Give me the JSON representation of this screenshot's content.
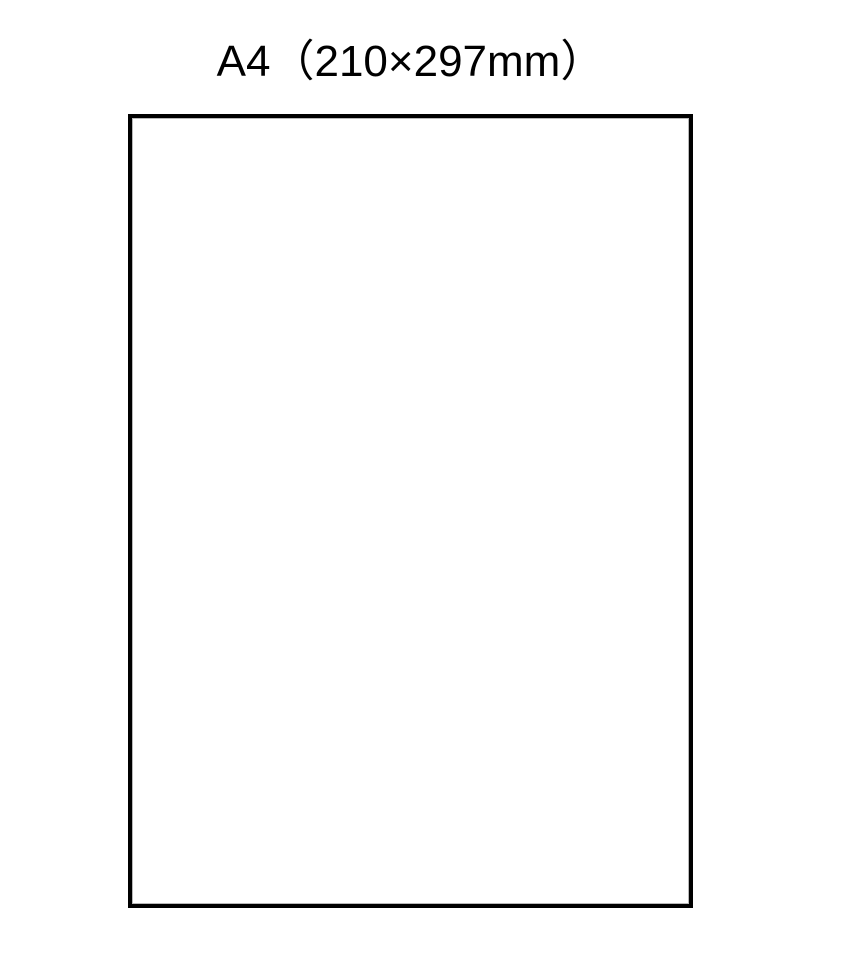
{
  "diagram": {
    "title": "A4（210×297mm）",
    "page_outline": {
      "format_label": "A4",
      "dimensions_label": "210×297mm",
      "border_color": "#000000",
      "inner_line_color": "#b8b8b8",
      "fill_color": "#ffffff"
    },
    "background_color": "#ffffff"
  }
}
